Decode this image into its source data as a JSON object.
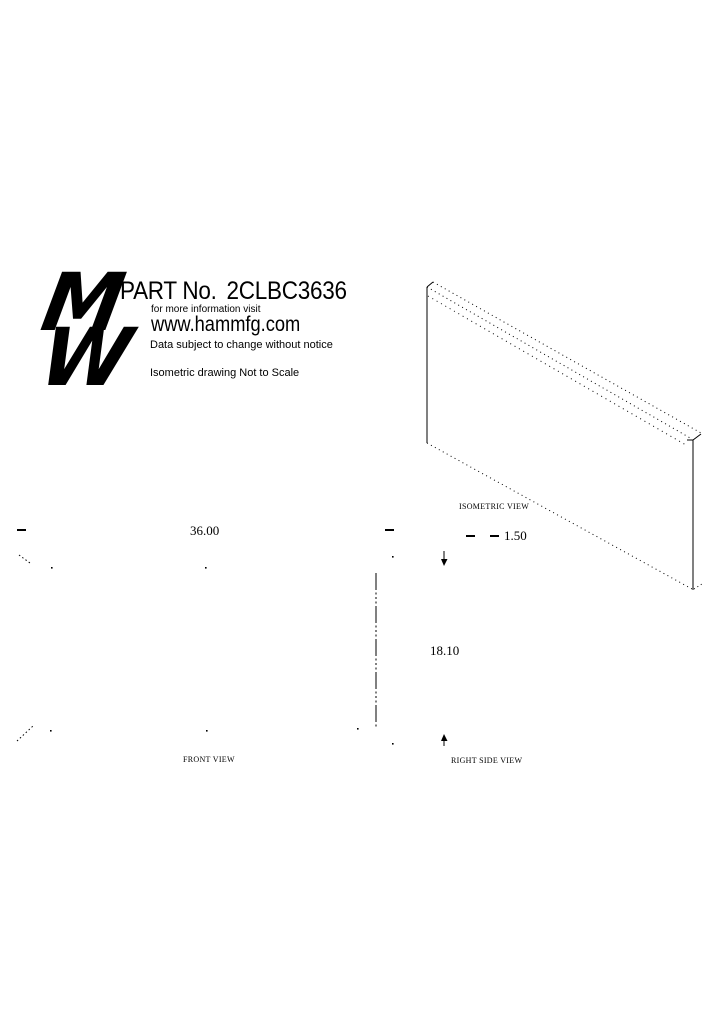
{
  "colors": {
    "ink": "#000000",
    "paper": "#ffffff"
  },
  "branding": {
    "logo_top_letter": "M",
    "logo_bottom_letter": "W"
  },
  "header": {
    "part_label": "PART No.",
    "part_number": "2CLBC3636",
    "info_line": "for more information visit",
    "website": "www.hammfg.com",
    "disclaimer": "Data subject to change without notice",
    "scale_note": "Isometric drawing Not to Scale"
  },
  "views": {
    "isometric": {
      "caption": "ISOMETRIC VIEW",
      "thickness_dim": "1.50"
    },
    "front": {
      "caption": "FRONT VIEW",
      "width_dim": "36.00"
    },
    "right_side": {
      "caption": "RIGHT SIDE VIEW",
      "height_dim": "18.10"
    }
  }
}
